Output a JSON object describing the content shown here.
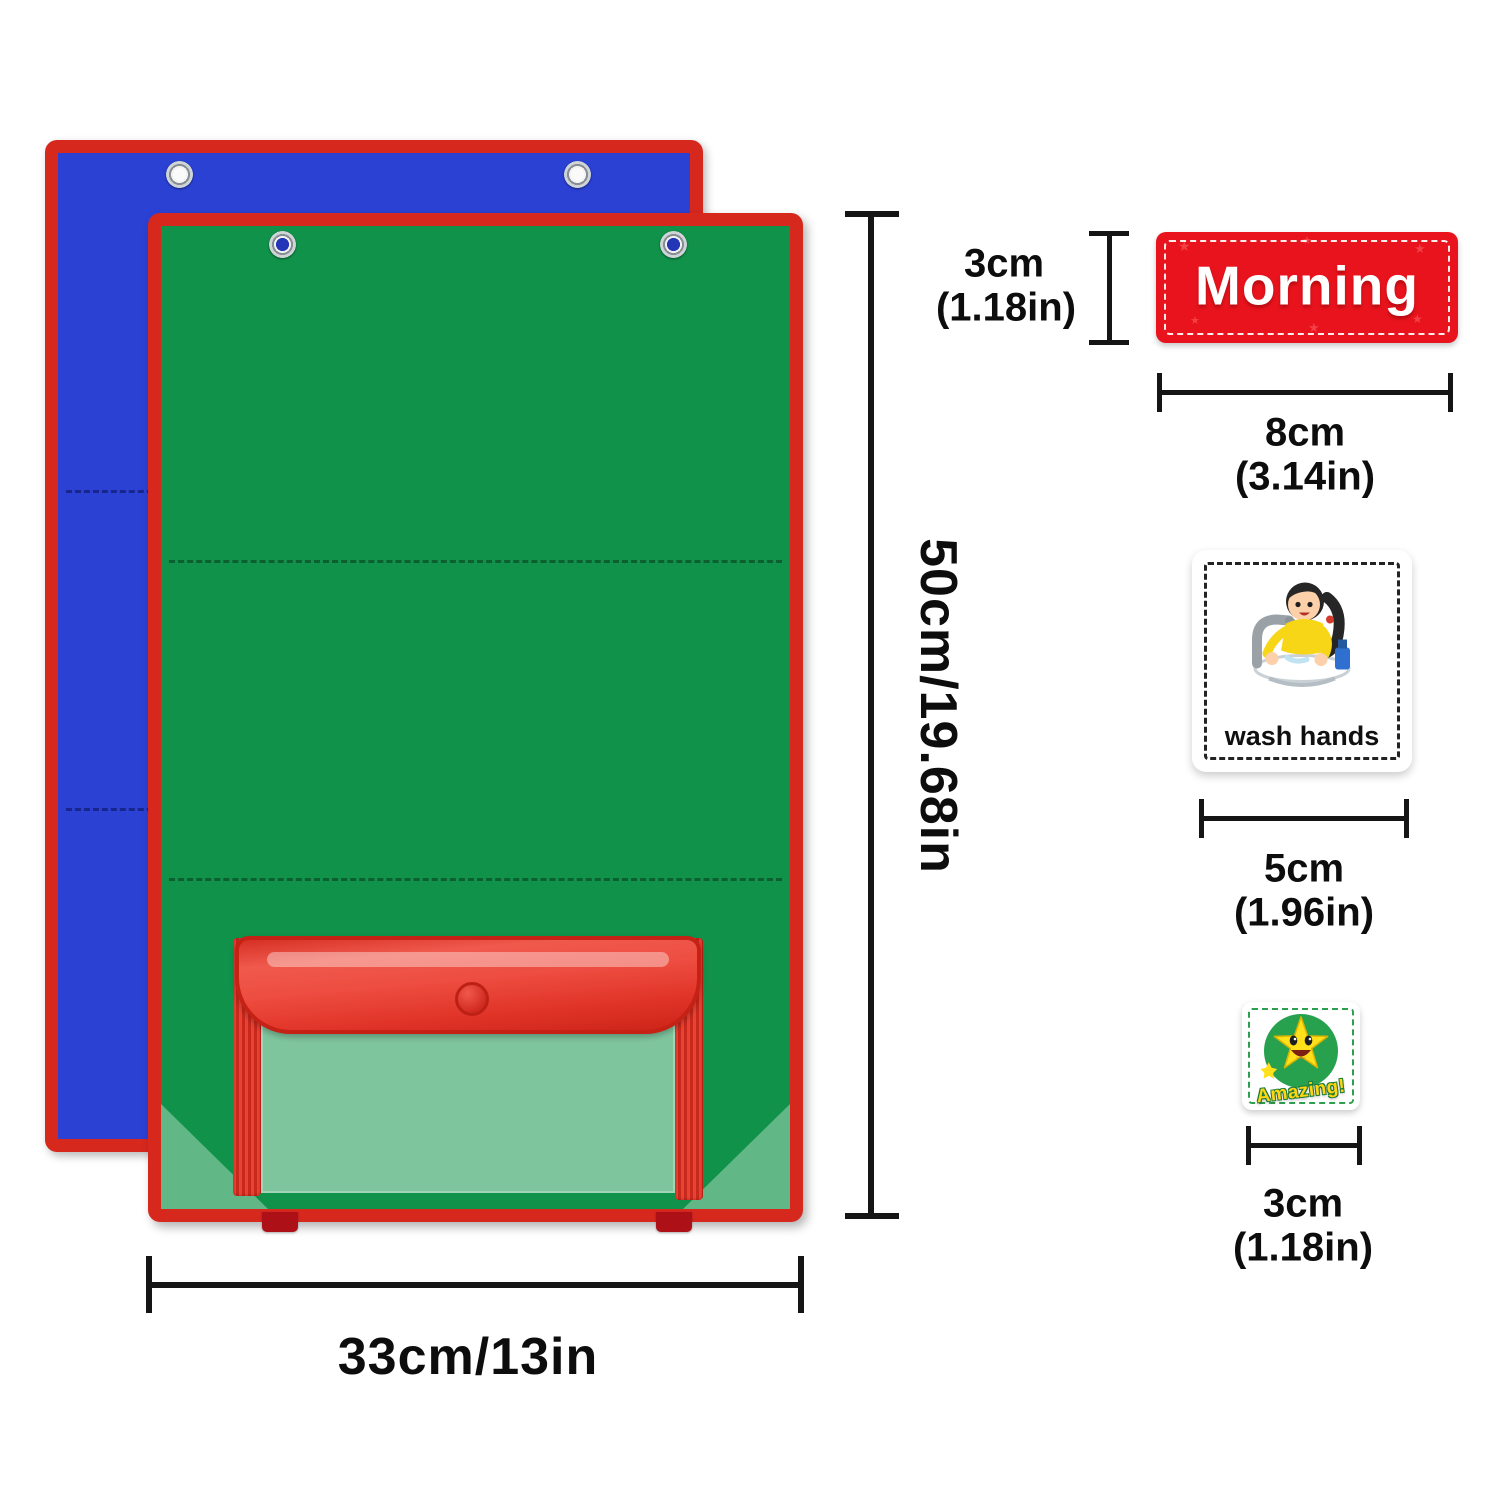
{
  "product": {
    "back_chart": {
      "fill": "#2a41d4",
      "border": "#d7281e"
    },
    "front_chart": {
      "fill": "#11924a",
      "border": "#d7281e"
    }
  },
  "annotations": {
    "chart_height": "50cm/19.68in",
    "chart_width": "33cm/13in",
    "word_card_height_cm": "3cm",
    "word_card_height_in": "(1.18in)",
    "word_card_width_cm": "8cm",
    "word_card_width_in": "(3.14in)",
    "picture_card_width_cm": "5cm",
    "picture_card_width_in": "(1.96in)",
    "sticker_width_cm": "3cm",
    "sticker_width_in": "(1.18in)"
  },
  "cards": {
    "morning_label": "Morning",
    "wash_hands_label": "wash hands",
    "amazing_label": "Amazing!"
  }
}
